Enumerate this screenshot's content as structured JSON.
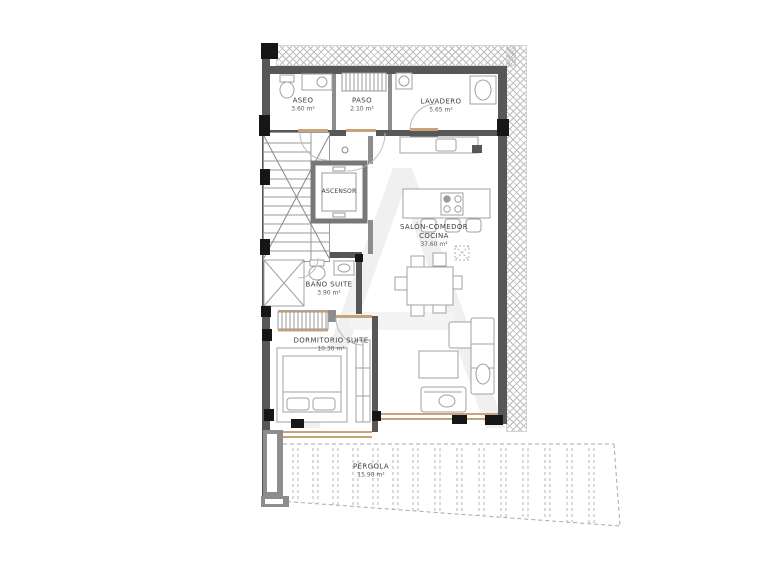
{
  "colors": {
    "wall": "#575757",
    "accent": "#c9a27a",
    "hatch": "#bdbdbd",
    "line": "#a0a0a0",
    "label": "#3d3d3d",
    "column": "#161616"
  },
  "rooms": {
    "aseo": {
      "name": "ASEO",
      "area": "3.60 m²"
    },
    "paso": {
      "name": "PASO",
      "area": "2.10 m²"
    },
    "lavadero": {
      "name": "LAVADERO",
      "area": "5.65 m²"
    },
    "ascensor": {
      "name": "ASCENSOR"
    },
    "salon": {
      "name": "SALÓN-COMEDOR",
      "name2": "COCINA",
      "area": "37.60 m²"
    },
    "bano_suite": {
      "name": "BAÑO SUITE",
      "area": "3.90 m²"
    },
    "dormitorio_suite": {
      "name": "DORMITORIO SUITE",
      "area": "10.30 m²"
    },
    "pergola": {
      "name": "PÉRGOLA",
      "area": "15.90 m²"
    }
  }
}
